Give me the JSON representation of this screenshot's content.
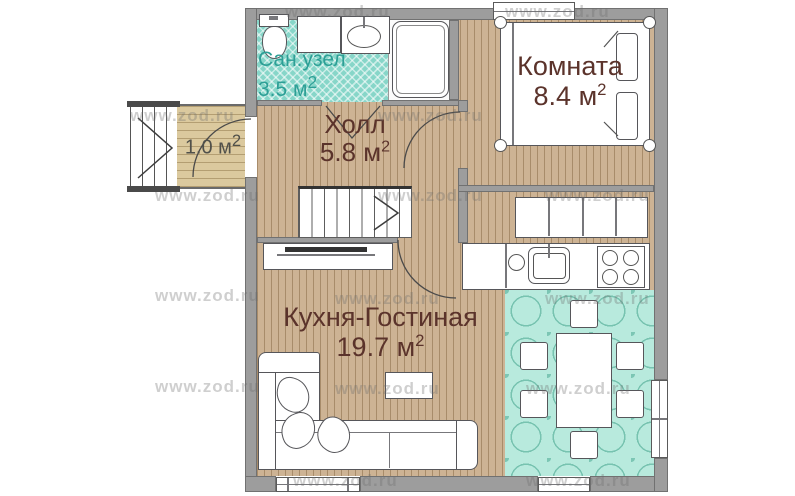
{
  "rooms": {
    "bathroom": {
      "name": "Сан.узел",
      "area": "3.5 м",
      "sup": "2"
    },
    "room": {
      "name": "Комната",
      "area": "8.4 м",
      "sup": "2"
    },
    "hall": {
      "name": "Холл",
      "area": "5.8 м",
      "sup": "2"
    },
    "kitchen": {
      "name": "Кухня-Гостиная",
      "area": "19.7 м",
      "sup": "2"
    },
    "porch": {
      "area": "1.0 м",
      "sup": "2"
    }
  },
  "watermarks": {
    "text": "www.zod.ru",
    "color": "rgba(108,108,108,0.33)",
    "positions": [
      [
        285,
        2
      ],
      [
        505,
        2
      ],
      [
        130,
        106
      ],
      [
        378,
        106
      ],
      [
        155,
        186
      ],
      [
        378,
        186
      ],
      [
        545,
        186
      ],
      [
        155,
        286
      ],
      [
        335,
        289
      ],
      [
        545,
        289
      ],
      [
        155,
        377
      ],
      [
        335,
        379
      ],
      [
        526,
        379
      ],
      [
        293,
        471
      ],
      [
        526,
        471
      ]
    ]
  },
  "colors": {
    "wall": "#9d9d9d",
    "wood_floor": "#cdb394",
    "bathroom_tile": "#87d6c9",
    "dining_tile": "#b8eadd",
    "label_brown": "#5b332b",
    "label_teal": "#2d9f96",
    "label_gray": "#50504a"
  }
}
